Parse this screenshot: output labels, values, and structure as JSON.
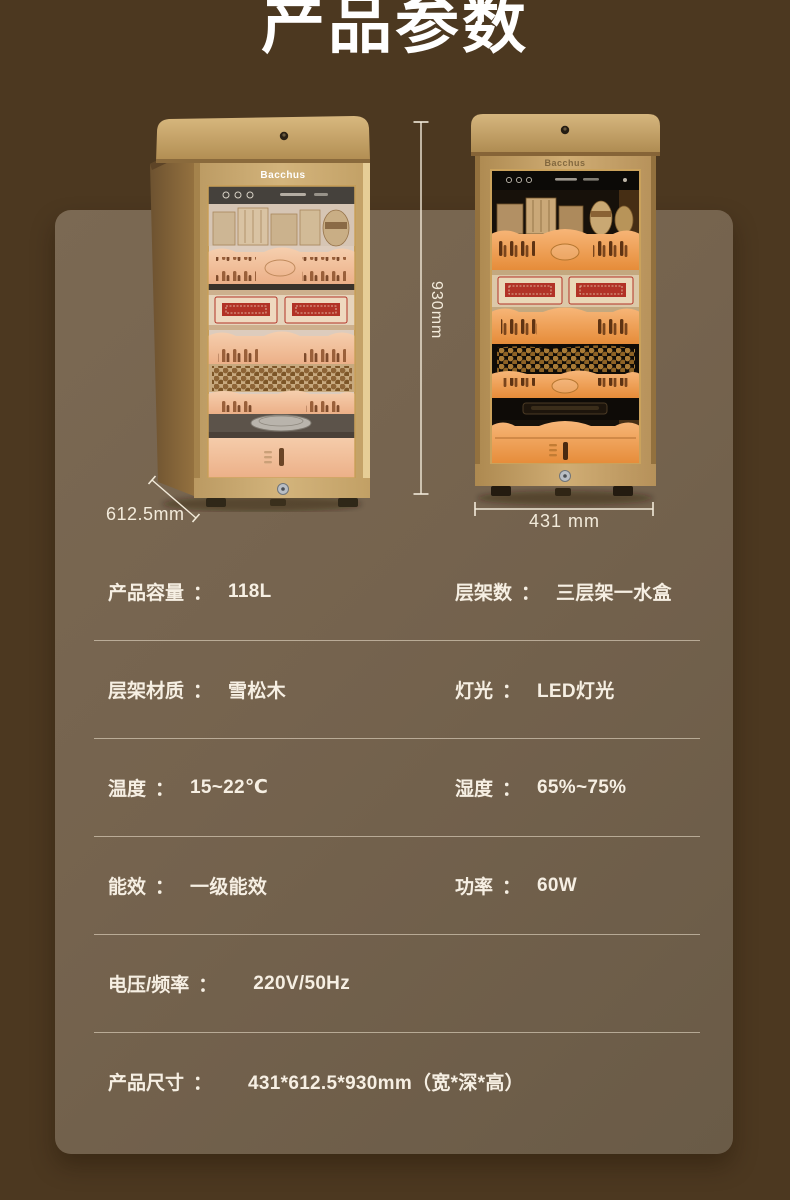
{
  "page": {
    "title": "产品参数",
    "bg_color": "#4c3820",
    "panel_color": "#75634e",
    "text_color": "#f6efe3",
    "accent_wood_color": "#c7a36a",
    "shelf_orange_color": "#f0a55c",
    "box_red_color": "#b23226"
  },
  "product": {
    "brand": "Bacchus"
  },
  "dimensions": {
    "height": "930mm",
    "depth": "612.5mm",
    "width": "431 mm"
  },
  "specs": {
    "separator": "：",
    "rows": [
      {
        "left": {
          "label": "产品容量",
          "value": "118L"
        },
        "right": {
          "label": "层架数",
          "value": "三层架一水盒"
        }
      },
      {
        "left": {
          "label": "层架材质",
          "value": "雪松木"
        },
        "right": {
          "label": "灯光",
          "value": "LED灯光"
        }
      },
      {
        "left": {
          "label": "温度",
          "value": "15~22℃"
        },
        "right": {
          "label": "湿度",
          "value": "65%~75%"
        }
      },
      {
        "left": {
          "label": "能效",
          "value": "一级能效"
        },
        "right": {
          "label": "功率",
          "value": "60W"
        }
      },
      {
        "left": {
          "label": "电压/频率",
          "value": "220V/50Hz"
        }
      },
      {
        "left": {
          "label": "产品尺寸",
          "value": "431*612.5*930mm（宽*深*高）"
        }
      }
    ]
  }
}
